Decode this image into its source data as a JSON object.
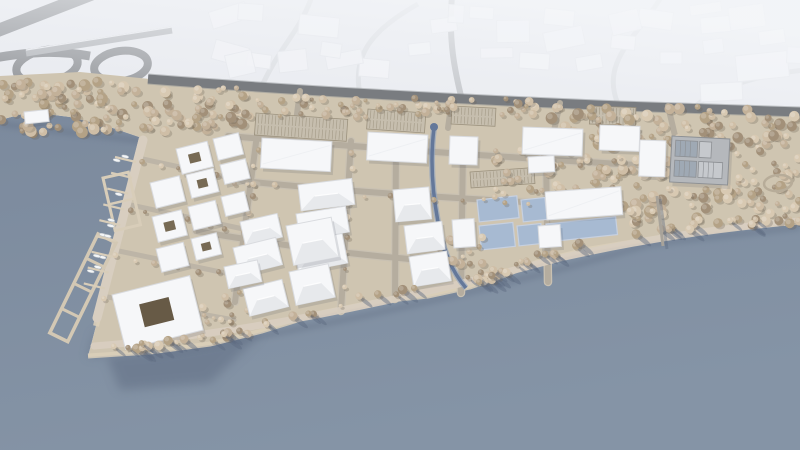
{
  "scene_label": "aerial-3d-masterplan-waterfront-development",
  "colors": {
    "context_bg": "#e7e9ee",
    "context_building": "#f3f4f7",
    "context_building_stroke": "#e1e3e8",
    "context_road_faint": "#d4d7db",
    "motorway": "#797c80",
    "bridge": "#a4a7ab",
    "water": "#7f8c9e",
    "water_light": "#8694a6",
    "shore_shadow": "#5d6b80",
    "land": "#cfc5b1",
    "sand": "#dacfba",
    "street_fill": "#b5ad9f",
    "street_casing": "#c9c1b2",
    "promenade": "#d8cec0",
    "tree_palette": [
      "#d8c9b2",
      "#cfbea6",
      "#c3b199",
      "#b4a286",
      "#a29079"
    ],
    "tree_shadow": "#6d6153",
    "building": "#f6f7f9",
    "building_shade": "#e7e9ec",
    "building_stroke": "#d9dbdf",
    "building_shadow": "#4a5160",
    "courtyard": "#776a54",
    "courtyard_dark": "#675a46",
    "basin": "#a7bad2",
    "basin_stroke": "#c6d0e0",
    "canal": "#64789a",
    "dock": "#d8cdb9",
    "boat": "#f4f6f7",
    "parking_fill": "#c6beae",
    "parking_line": "#9a907c",
    "structure": "#b5b8bc",
    "structure_dark": "#8d9094",
    "structure_panel": "#9fa9b4",
    "structure_light": "#c6c9cd",
    "pier": "#a8a39a",
    "trail": "#b7ac99"
  },
  "scene": {
    "context": {
      "random_count": 16,
      "fixed_buildings": [
        [
          300,
          14,
          40,
          20,
          6
        ],
        [
          360,
          58,
          30,
          18,
          5
        ],
        [
          408,
          44,
          22,
          12,
          -6
        ],
        [
          430,
          20,
          26,
          14,
          -8
        ],
        [
          470,
          6,
          24,
          12,
          4
        ],
        [
          520,
          52,
          30,
          16,
          4
        ],
        [
          545,
          8,
          30,
          16,
          6
        ],
        [
          575,
          58,
          26,
          14,
          -10
        ],
        [
          612,
          34,
          24,
          14,
          6
        ],
        [
          640,
          8,
          34,
          18,
          8
        ],
        [
          660,
          52,
          22,
          12,
          0
        ],
        [
          700,
          18,
          30,
          16,
          -5
        ],
        [
          700,
          84,
          42,
          18,
          -3
        ],
        [
          735,
          56,
          52,
          26,
          -6
        ],
        [
          758,
          32,
          26,
          14,
          -8
        ],
        [
          248,
          52,
          24,
          14,
          8
        ]
      ]
    },
    "parking_lots": [
      [
        256,
        113,
        92,
        22,
        4
      ],
      [
        368,
        109,
        58,
        20,
        4
      ],
      [
        452,
        106,
        44,
        18,
        3
      ],
      [
        590,
        106,
        46,
        18,
        2
      ],
      [
        470,
        172,
        64,
        16,
        -4
      ]
    ],
    "basins": [
      [
        477,
        200,
        40,
        22,
        -6
      ],
      [
        479,
        226,
        34,
        24,
        -6
      ],
      [
        521,
        200,
        24,
        22,
        -6
      ],
      [
        517,
        226,
        24,
        20,
        -6
      ],
      [
        546,
        224,
        70,
        18,
        -6
      ]
    ],
    "buildings": [
      [
        262,
        138,
        70,
        30,
        3,
        "flat"
      ],
      [
        368,
        132,
        60,
        28,
        3,
        "flat"
      ],
      [
        450,
        136,
        28,
        28,
        2,
        "flat"
      ],
      [
        523,
        127,
        60,
        27,
        2,
        "flat"
      ],
      [
        600,
        125,
        40,
        25,
        2,
        "flat"
      ],
      [
        640,
        140,
        26,
        36,
        2,
        "flat"
      ],
      [
        528,
        157,
        26,
        16,
        -3,
        "flat"
      ],
      [
        545,
        192,
        76,
        28,
        -4,
        "flat"
      ],
      [
        298,
        185,
        54,
        26,
        -7,
        "pitched"
      ],
      [
        296,
        214,
        50,
        26,
        -9,
        "pitched"
      ],
      [
        293,
        243,
        50,
        30,
        -11,
        "pitched"
      ],
      [
        393,
        190,
        36,
        32,
        -5,
        "pitched"
      ],
      [
        404,
        226,
        38,
        28,
        -7,
        "pitched"
      ],
      [
        409,
        257,
        38,
        30,
        -9,
        "pitched"
      ],
      [
        452,
        220,
        22,
        28,
        -4,
        "flat"
      ],
      [
        538,
        226,
        22,
        22,
        -4,
        "flat"
      ],
      [
        240,
        222,
        38,
        24,
        -13,
        "pitched"
      ],
      [
        286,
        226,
        46,
        40,
        -11,
        "pitched"
      ],
      [
        233,
        248,
        44,
        28,
        -14,
        "pitched"
      ],
      [
        289,
        272,
        40,
        34,
        -12,
        "pitched"
      ],
      [
        243,
        289,
        40,
        28,
        -14,
        "pitched"
      ],
      [
        224,
        267,
        34,
        22,
        -12,
        "pitched"
      ],
      [
        176,
        149,
        32,
        26,
        -14,
        "court"
      ],
      [
        213,
        139,
        26,
        22,
        -14,
        "flat"
      ],
      [
        150,
        183,
        30,
        26,
        -14,
        "flat"
      ],
      [
        186,
        175,
        28,
        24,
        -14,
        "court"
      ],
      [
        220,
        165,
        26,
        20,
        -14,
        "flat"
      ],
      [
        152,
        217,
        30,
        26,
        -14,
        "court"
      ],
      [
        188,
        207,
        28,
        24,
        -14,
        "flat"
      ],
      [
        221,
        197,
        24,
        20,
        -14,
        "flat"
      ],
      [
        156,
        249,
        28,
        24,
        -14,
        "flat"
      ],
      [
        191,
        239,
        26,
        22,
        -14,
        "court"
      ],
      [
        112,
        295,
        80,
        56,
        -14,
        "court-large"
      ],
      [
        24,
        112,
        24,
        12,
        -6,
        "flat"
      ]
    ],
    "tree_bands": [
      {
        "x0": 0,
        "x1": 150,
        "y0": 80,
        "y1": 134,
        "n": 80,
        "rmin": 2.5,
        "rmax": 6
      },
      {
        "x0": 150,
        "x1": 245,
        "y0": 88,
        "y1": 132,
        "n": 50,
        "rmin": 2.5,
        "rmax": 5.5
      },
      {
        "x0": 245,
        "x1": 540,
        "y0": 97,
        "y1": 117,
        "n": 60,
        "rmin": 2,
        "rmax": 4.5
      },
      {
        "x0": 540,
        "x1": 800,
        "y0": 106,
        "y1": 148,
        "n": 80,
        "rmin": 2.5,
        "rmax": 6
      },
      {
        "x0": 618,
        "x1": 800,
        "y0": 148,
        "y1": 224,
        "n": 130,
        "rmin": 2.5,
        "rmax": 6,
        "skip": [
          668,
          130,
          736,
          188
        ]
      },
      {
        "x0": 545,
        "x1": 622,
        "y0": 150,
        "y1": 190,
        "n": 28,
        "rmin": 2,
        "rmax": 5
      },
      {
        "x0": 488,
        "x1": 545,
        "y0": 148,
        "y1": 198,
        "n": 20,
        "rmin": 2,
        "rmax": 5
      },
      {
        "x0": 196,
        "x1": 248,
        "y0": 296,
        "y1": 338,
        "n": 14,
        "rmin": 2,
        "rmax": 4.5
      },
      {
        "x0": 438,
        "x1": 484,
        "y0": 236,
        "y1": 264,
        "n": 18,
        "rmin": 2,
        "rmax": 5
      }
    ],
    "tree_lines": [
      [
        257,
        150,
        240,
        295,
        9
      ],
      [
        351,
        150,
        343,
        305,
        9
      ],
      [
        250,
        186,
        530,
        205,
        12
      ],
      [
        140,
        162,
        253,
        186,
        6
      ],
      [
        128,
        208,
        246,
        232,
        6
      ],
      [
        116,
        254,
        238,
        278,
        6
      ],
      [
        104,
        300,
        232,
        322,
        6
      ]
    ],
    "shoreline_trees": {
      "points": [
        [
          110,
          350
        ],
        [
          150,
          350
        ],
        [
          210,
          342
        ],
        [
          262,
          330
        ],
        [
          320,
          312
        ],
        [
          380,
          300
        ],
        [
          428,
          295
        ],
        [
          470,
          286
        ],
        [
          505,
          274
        ],
        [
          540,
          260
        ],
        [
          590,
          248
        ],
        [
          650,
          238
        ],
        [
          700,
          231
        ],
        [
          760,
          224
        ]
      ],
      "n": 64
    },
    "marina": {
      "finger_start": [
        136,
        162
      ],
      "finger_step": [
        -3.9,
        15.8
      ],
      "finger_count": 9,
      "finger_dir": [
        -21,
        -5
      ]
    }
  }
}
